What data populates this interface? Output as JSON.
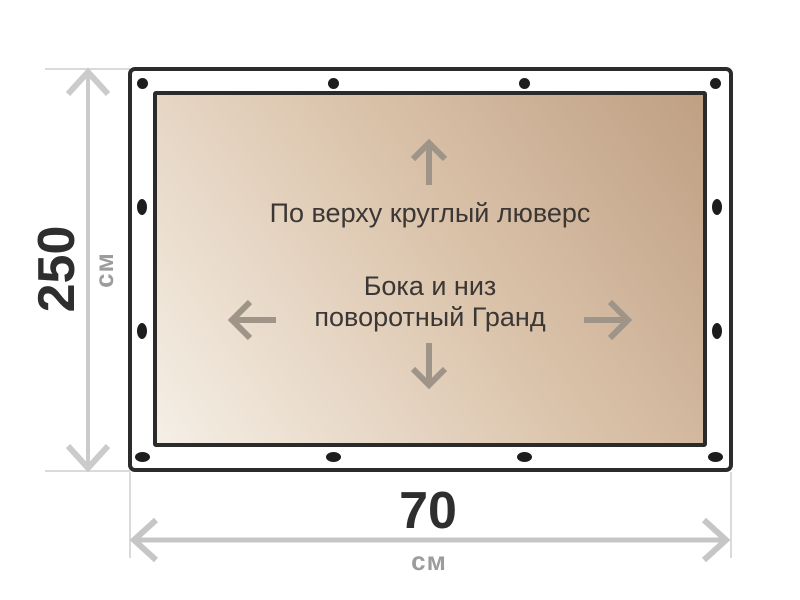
{
  "diagram": {
    "note_top": "По верху круглый люверс",
    "note_center_line1": "Бока и низ",
    "note_center_line2": "поворотный Гранд",
    "height_dimension": {
      "value": "250",
      "unit": "см"
    },
    "width_dimension": {
      "value": "70",
      "unit": "см"
    }
  },
  "grommets": {
    "top_edge": {
      "shape": "round",
      "count": 4
    },
    "bottom_edge": {
      "shape": "oval-horizontal",
      "count": 4
    },
    "left_edge": {
      "shape": "oval-vertical",
      "count": 2
    },
    "right_edge": {
      "shape": "oval-vertical",
      "count": 2
    },
    "color": "#1d1d1d"
  },
  "colors": {
    "frame_border": "#2b2b2b",
    "panel_gradient_light": "#f5efe6",
    "panel_gradient_dark": "#bfa083",
    "dimension_line": "#cbcbcb",
    "extension_line": "#dadada",
    "value_text": "#2e2e2e",
    "unit_text": "#9c9c9c",
    "note_text": "#3b3734",
    "direction_arrow": "#9e9488",
    "background": "#ffffff"
  }
}
